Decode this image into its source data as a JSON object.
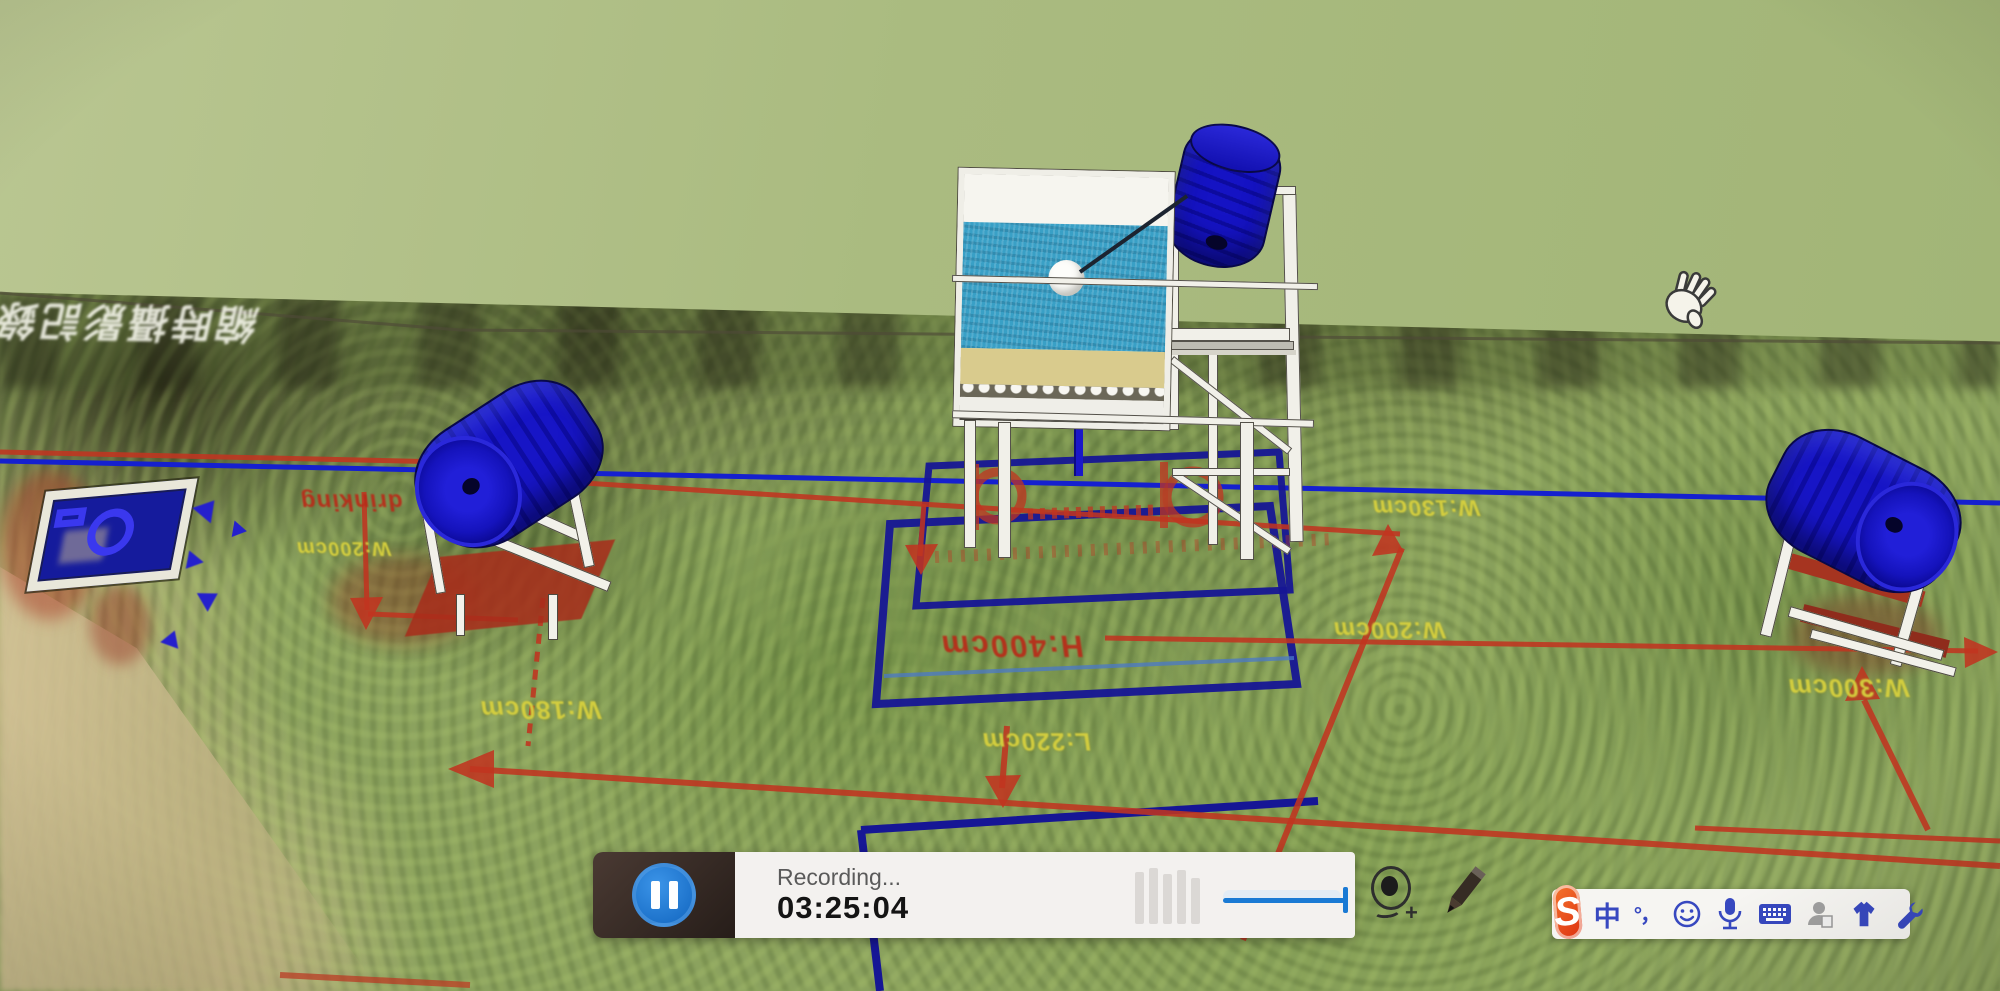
{
  "app": {
    "viewport": "3d-model-scene",
    "cursor": "pan-hand"
  },
  "colors": {
    "wall_green": "#aebb84",
    "ground_green": "#8ba25e",
    "dimension_red": "#bc2c1a",
    "dimension_yellow": "#d7d13e",
    "outline_navy": "#161695",
    "guide_blue": "#1520cf",
    "barrel_blue": "#1513c4",
    "pause_blue": "#1a7ad4",
    "sogou_orange": "#e8491c",
    "ime_blue": "#3748c0"
  },
  "scene": {
    "watermark": "縮時攝影記錄",
    "dimension_labels": {
      "drinking": "drinking",
      "h80": "H:80cm",
      "w200_left": "W:200cm",
      "w180": "W:180cm",
      "h400": "H:400cm",
      "l220": "L:220cm",
      "w130": "W:130cm",
      "w200_right": "W:200cm",
      "w300": "W:300cm"
    }
  },
  "recorder": {
    "status": "Recording...",
    "time": "03:25:04"
  },
  "ime": {
    "logo": "S",
    "language": "中",
    "punctuation": "°，"
  }
}
